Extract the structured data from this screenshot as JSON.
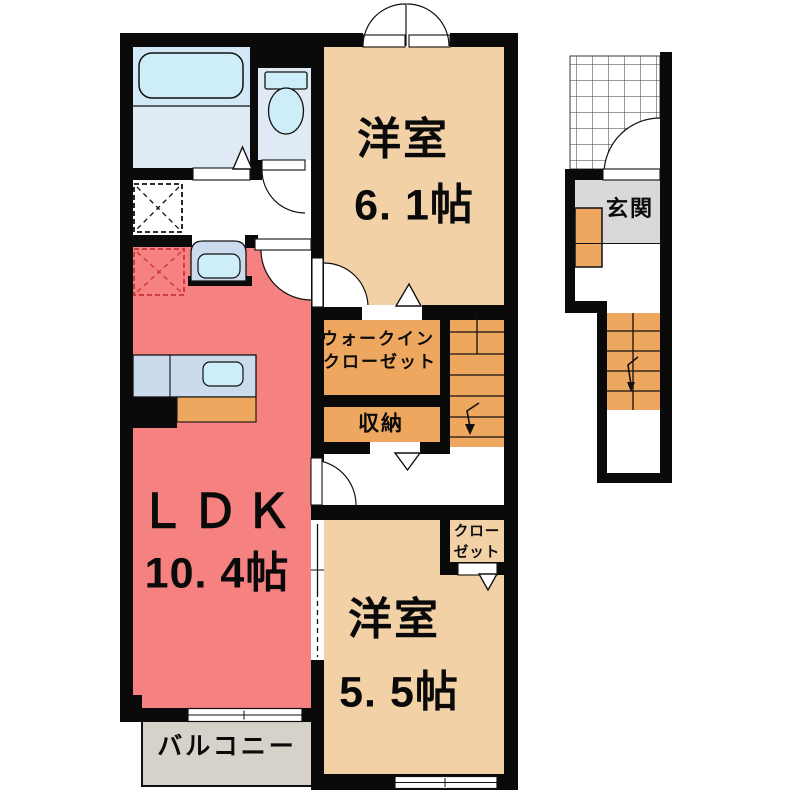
{
  "floorplan": {
    "rooms": {
      "bedroom1": {
        "label": "洋室",
        "size": "6. 1帖"
      },
      "ldk": {
        "label": "ＬＤＫ",
        "size": "10. 4帖"
      },
      "bedroom2": {
        "label": "洋室",
        "size": "5. 5帖"
      },
      "wic": {
        "label_line1": "ウォークイン",
        "label_line2": "クローゼット"
      },
      "storage": {
        "label": "収納"
      },
      "closet": {
        "label_line1": "クロー",
        "label_line2": "ゼット"
      },
      "entrance": {
        "label": "玄関"
      },
      "balcony": {
        "label": "バルコニー"
      }
    },
    "icons": {
      "bathtub": "bathtub-icon",
      "toilet": "toilet-icon",
      "washbasin": "washbasin-icon",
      "kitchen_sink": "kitchen-sink-icon",
      "washing_machine_pan": "washing-machine-pan-icon",
      "refrigerator_space": "refrigerator-space-icon",
      "stairs_down_arrow": "stairs-down-arrow-icon"
    },
    "colors": {
      "wall": "#0a0a0a",
      "bedroom_floor": "#f2d1a7",
      "ldk_floor": "#f58181",
      "closet_floor": "#eea75f",
      "bath_floor": "#dfeaf5",
      "tub_zone": "#d2e8f6",
      "fixture_blue": "#cdeef8",
      "counter_blue": "#ccdaee",
      "entrance_floor": "#d9d9d9",
      "balcony_floor": "#d6d2c9",
      "refrigerator_dash": "#cc3333"
    }
  }
}
